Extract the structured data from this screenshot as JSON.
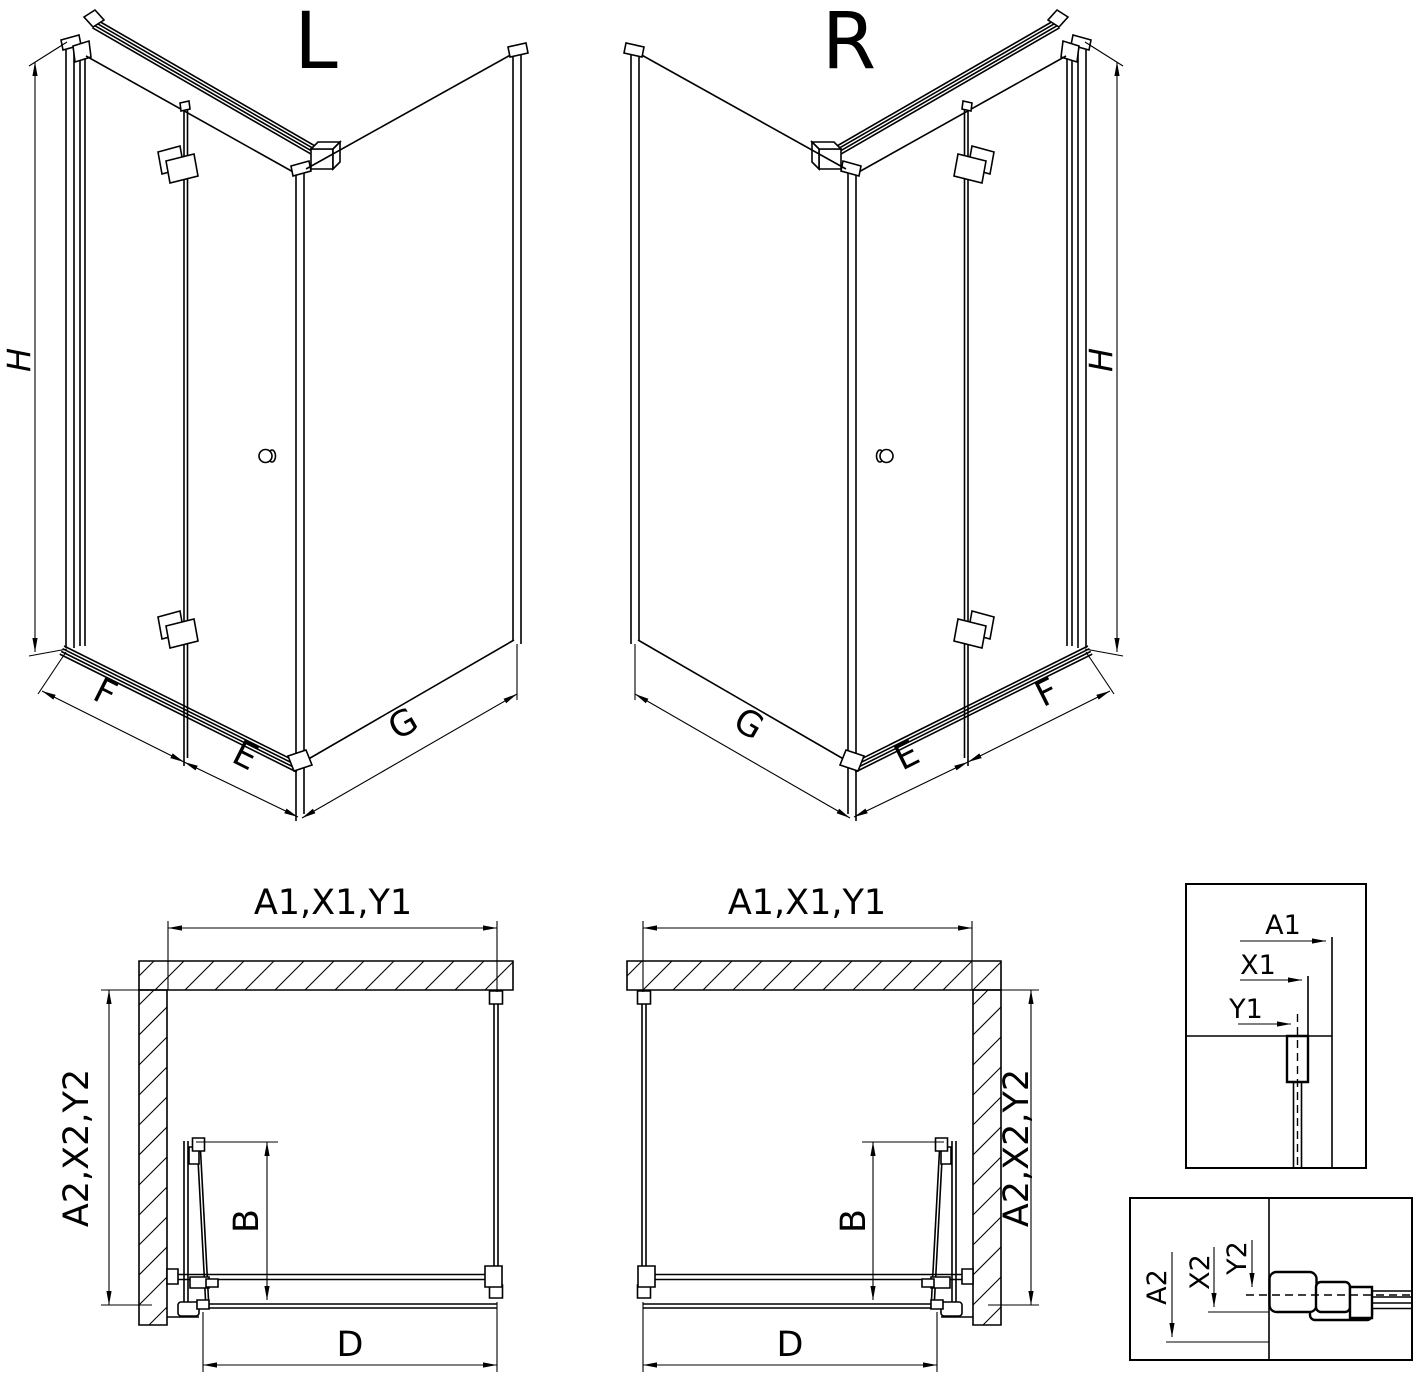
{
  "views": {
    "iso_left": {
      "title": "L",
      "height_dim": "H",
      "front_dim": "F",
      "door_dim": "E",
      "side_dim": "G"
    },
    "iso_right": {
      "title": "R",
      "height_dim": "H",
      "front_dim": "F",
      "door_dim": "E",
      "side_dim": "G"
    },
    "plan_left": {
      "width_dim": "A1,X1,Y1",
      "depth_dim": "A2,X2,Y2",
      "door_dim": "B",
      "entry_dim": "D"
    },
    "plan_right": {
      "width_dim": "A1,X1,Y1",
      "depth_dim": "A2,X2,Y2",
      "door_dim": "B",
      "entry_dim": "D"
    },
    "detail_top": {
      "dim_a": "A1",
      "dim_x": "X1",
      "dim_y": "Y1"
    },
    "detail_bottom": {
      "dim_a": "A2",
      "dim_x": "X2",
      "dim_y": "Y2"
    }
  },
  "colors": {
    "line": "#000000",
    "background": "#ffffff"
  }
}
